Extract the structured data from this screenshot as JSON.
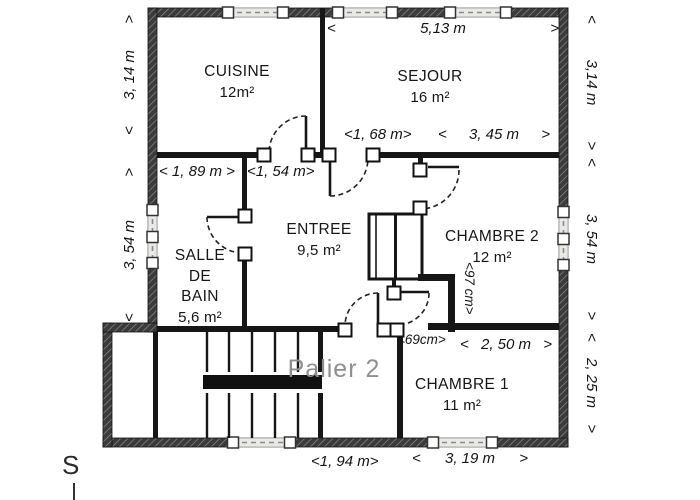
{
  "title": "Floor plan - Palier 2",
  "rooms": {
    "cuisine": {
      "name": "CUISINE",
      "area": "12m²"
    },
    "sejour": {
      "name": "SEJOUR",
      "area": "16 m²"
    },
    "entree": {
      "name": "ENTREE",
      "area": "9,5 m²"
    },
    "salle_de_bain": {
      "line1": "SALLE",
      "line2": "DE",
      "line3": "BAIN",
      "area": "5,6 m²"
    },
    "chambre2": {
      "name": "CHAMBRE 2",
      "area": "12 m²"
    },
    "chambre1": {
      "name": "CHAMBRE 1",
      "area": "11 m²"
    },
    "palier": {
      "name": "Palier 2"
    }
  },
  "dimensions": {
    "top_sejour": {
      "start": "<",
      "text": "5,13 m",
      "end": ">"
    },
    "left_upper": {
      "start": "<",
      "text": "3, 14 m",
      "end": ">"
    },
    "left_lower": {
      "start": "<",
      "text": "3, 54 m",
      "end": ">"
    },
    "right_upper": {
      "start": "<",
      "text": "3,14 m",
      "end": ">"
    },
    "right_middle": {
      "start": "<",
      "text": "3, 54 m",
      "end": ">"
    },
    "right_lower": {
      "start": "<",
      "text": "2, 25 m",
      "end": ">"
    },
    "bain_width": {
      "text": "< 1, 89 m >"
    },
    "entree_width": {
      "text": "<1, 54 m>"
    },
    "sejour_door": {
      "text": "<1, 68 m>"
    },
    "sejour_width": {
      "start": "<",
      "text": "3, 45 m",
      "end": ">"
    },
    "chambre2_step": {
      "text": "<97 cm>"
    },
    "chambre1_door": {
      "text": "<69cm>"
    },
    "chambre1_top": {
      "start": "<",
      "text": "2, 50 m",
      "end": ">"
    },
    "bottom_left": {
      "text": "<1, 94 m>"
    },
    "bottom_right": {
      "start": "<",
      "text": "3, 19 m",
      "end": ">"
    }
  },
  "compass": {
    "label": "S"
  },
  "colors": {
    "interior_wall": "#161616",
    "outer_wall": "#3b3b3b",
    "window_fill": "#e9e9e5",
    "arc_line": "#222222",
    "palier_text": "#8f8f8f",
    "paper": "#ffffff"
  }
}
